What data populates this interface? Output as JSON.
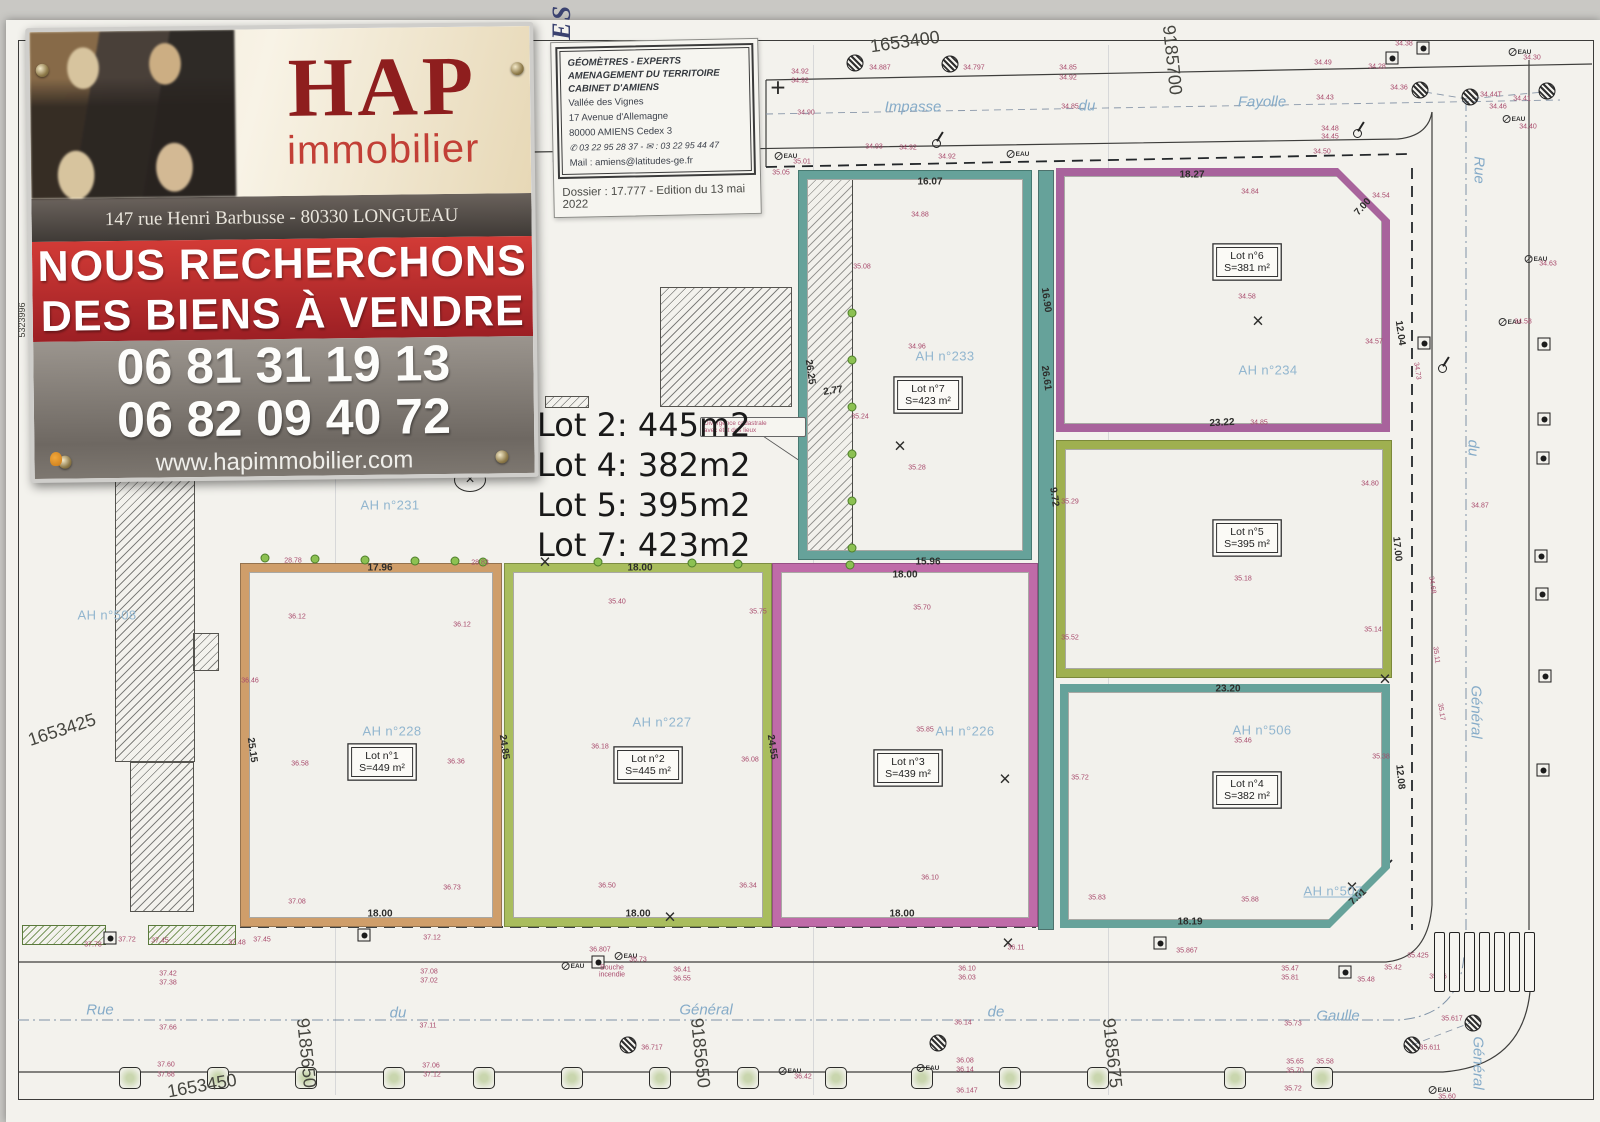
{
  "banner": {
    "brand": "HAP",
    "brand_sub": "immobilier",
    "address": "147 rue Henri Barbusse - 80330 LONGUEAU",
    "line1": "NOUS RECHERCHONS",
    "line2": "DES BIENS À VENDRE",
    "phone1": "06 81 31 19 13",
    "phone2": "06 82 09 40 72",
    "website": "www.hapimmobilier.com",
    "accent_red": "#c0272d",
    "brand_red": "#8e1e1e"
  },
  "cartouche": {
    "side": "LATITUDES",
    "org1": "GÉOMÈTRES - EXPERTS",
    "org2": "AMENAGEMENT DU TERRITOIRE",
    "org3": "CABINET D'AMIENS",
    "addr1": "Vallée des Vignes",
    "addr2": "17 Avenue d'Allemagne",
    "addr3": "80000 AMIENS Cedex 3",
    "tel": "✆ 03 22 95 28 37 - ✉ : 03 22 95 44 47",
    "mail": "Mail : amiens@latitudes-ge.fr",
    "dossier": "Dossier : 17.777 - Edition du 13 mai 2022"
  },
  "notes": {
    "lines": [
      "Lot 2: 445m2",
      "Lot 4: 382m2",
      "Lot 5: 395m2",
      "Lot 7: 423m2"
    ]
  },
  "callout": {
    "line1": "Divergence cadastrale",
    "line2": "avec état des lieux"
  },
  "plan": {
    "eau_label": "EAU",
    "lots": [
      {
        "label": "Lot n°1",
        "area": "S=449 m²"
      },
      {
        "label": "Lot n°2",
        "area": "S=445 m²"
      },
      {
        "label": "Lot n°3",
        "area": "S=439 m²"
      },
      {
        "label": "Lot n°4",
        "area": "S=382 m²"
      },
      {
        "label": "Lot n°5",
        "area": "S=395 m²"
      },
      {
        "label": "Lot n°6",
        "area": "S=381 m²"
      },
      {
        "label": "Lot n°7",
        "area": "S=423 m²"
      }
    ],
    "parcels": [
      {
        "t": "AH n°231",
        "x": 390,
        "y": 505
      },
      {
        "t": "AH n°508",
        "x": 107,
        "y": 615
      },
      {
        "t": "AH n°228",
        "x": 392,
        "y": 731
      },
      {
        "t": "AH n°227",
        "x": 662,
        "y": 722
      },
      {
        "t": "AH n°226",
        "x": 965,
        "y": 731
      },
      {
        "t": "AH n°233",
        "x": 945,
        "y": 356
      },
      {
        "t": "AH n°234",
        "x": 1268,
        "y": 370
      },
      {
        "t": "AH n°506",
        "x": 1262,
        "y": 730
      },
      {
        "t": "AH n°507",
        "x": 1333,
        "y": 891,
        "u": 1
      }
    ],
    "streets": [
      {
        "t": "Impasse",
        "x": 913,
        "y": 107
      },
      {
        "t": "du",
        "x": 1087,
        "y": 106
      },
      {
        "t": "Fayolle",
        "x": 1262,
        "y": 102
      },
      {
        "t": "Rue",
        "x": 1479,
        "y": 170,
        "r": 90
      },
      {
        "t": "du",
        "x": 1473,
        "y": 448,
        "r": 90
      },
      {
        "t": "Général",
        "x": 1476,
        "y": 712,
        "r": 90
      },
      {
        "t": "Général",
        "x": 1478,
        "y": 1063,
        "r": 90
      },
      {
        "t": "Rue",
        "x": 100,
        "y": 1010
      },
      {
        "t": "du",
        "x": 398,
        "y": 1013
      },
      {
        "t": "Général",
        "x": 706,
        "y": 1010
      },
      {
        "t": "de",
        "x": 996,
        "y": 1012
      },
      {
        "t": "Gaulle",
        "x": 1338,
        "y": 1016
      }
    ],
    "coords": [
      {
        "t": "1653400",
        "x": 905,
        "y": 42,
        "r": -8
      },
      {
        "t": "9185700",
        "x": 1172,
        "y": 60,
        "r": 84
      },
      {
        "t": "1653425",
        "x": 62,
        "y": 730,
        "r": -18
      },
      {
        "t": "1653450",
        "x": 202,
        "y": 1086,
        "r": -10
      },
      {
        "t": "9185650",
        "x": 306,
        "y": 1053,
        "r": 84
      },
      {
        "t": "9185650",
        "x": 700,
        "y": 1053,
        "r": 84
      },
      {
        "t": "9185675",
        "x": 1112,
        "y": 1053,
        "r": 84
      },
      {
        "t": "5323996",
        "x": 22,
        "y": 320,
        "r": -90,
        "s": 9
      }
    ],
    "dims": [
      {
        "t": "16.07",
        "x": 930,
        "y": 182
      },
      {
        "t": "18.27",
        "x": 1192,
        "y": 175
      },
      {
        "t": "7.00",
        "x": 1363,
        "y": 207,
        "r": -48
      },
      {
        "t": "16.90",
        "x": 1046,
        "y": 300,
        "r": 82
      },
      {
        "t": "26.61",
        "x": 1046,
        "y": 378,
        "r": 82
      },
      {
        "t": "26.25",
        "x": 810,
        "y": 372,
        "r": 82
      },
      {
        "t": "2.77",
        "x": 833,
        "y": 391,
        "r": -8
      },
      {
        "t": "12.04",
        "x": 1400,
        "y": 333,
        "r": 82
      },
      {
        "t": "23.22",
        "x": 1222,
        "y": 423,
        "r": -3
      },
      {
        "t": "9.72",
        "x": 1054,
        "y": 497,
        "r": 82
      },
      {
        "t": "17.00",
        "x": 1397,
        "y": 549,
        "r": 84
      },
      {
        "t": "15.96",
        "x": 928,
        "y": 562
      },
      {
        "t": "18.00",
        "x": 905,
        "y": 575
      },
      {
        "t": "17.96",
        "x": 380,
        "y": 568
      },
      {
        "t": "18.00",
        "x": 640,
        "y": 568
      },
      {
        "t": "25.15",
        "x": 252,
        "y": 750,
        "r": 82
      },
      {
        "t": "24.85",
        "x": 504,
        "y": 747,
        "r": 82
      },
      {
        "t": "24.55",
        "x": 772,
        "y": 747,
        "r": 82
      },
      {
        "t": "23.20",
        "x": 1228,
        "y": 689
      },
      {
        "t": "12.08",
        "x": 1400,
        "y": 777,
        "r": 84
      },
      {
        "t": "18.00",
        "x": 380,
        "y": 914
      },
      {
        "t": "18.00",
        "x": 638,
        "y": 914
      },
      {
        "t": "18.00",
        "x": 902,
        "y": 914
      },
      {
        "t": "18.19",
        "x": 1190,
        "y": 922
      },
      {
        "t": "7.01",
        "x": 1358,
        "y": 897,
        "r": -42
      }
    ],
    "elev": [
      {
        "t": "34.92",
        "x": 800,
        "y": 72
      },
      {
        "t": "34.92",
        "x": 800,
        "y": 81
      },
      {
        "t": "34.90",
        "x": 806,
        "y": 113
      },
      {
        "t": "35.01",
        "x": 802,
        "y": 162
      },
      {
        "t": "35.05",
        "x": 781,
        "y": 173
      },
      {
        "t": "34.887",
        "x": 880,
        "y": 68
      },
      {
        "t": "34.797",
        "x": 974,
        "y": 68
      },
      {
        "t": "34.93",
        "x": 874,
        "y": 147
      },
      {
        "t": "34.92",
        "x": 908,
        "y": 148
      },
      {
        "t": "34.92",
        "x": 947,
        "y": 157
      },
      {
        "t": "34.85",
        "x": 1068,
        "y": 68
      },
      {
        "t": "34.92",
        "x": 1068,
        "y": 78
      },
      {
        "t": "34.85",
        "x": 1070,
        "y": 107
      },
      {
        "t": "34.49",
        "x": 1323,
        "y": 63
      },
      {
        "t": "34.28",
        "x": 1377,
        "y": 67
      },
      {
        "t": "34.43",
        "x": 1325,
        "y": 98
      },
      {
        "t": "34.48",
        "x": 1330,
        "y": 129
      },
      {
        "t": "34.45",
        "x": 1330,
        "y": 137
      },
      {
        "t": "34.50",
        "x": 1322,
        "y": 152
      },
      {
        "t": "34.38",
        "x": 1404,
        "y": 44
      },
      {
        "t": "34.36",
        "x": 1399,
        "y": 88
      },
      {
        "t": "34.44T",
        "x": 1491,
        "y": 95
      },
      {
        "t": "34.41",
        "x": 1522,
        "y": 99
      },
      {
        "t": "34.46",
        "x": 1498,
        "y": 107
      },
      {
        "t": "34.40",
        "x": 1528,
        "y": 127
      },
      {
        "t": "34.30",
        "x": 1532,
        "y": 58
      },
      {
        "t": "34.84",
        "x": 1250,
        "y": 192
      },
      {
        "t": "34.54",
        "x": 1381,
        "y": 196
      },
      {
        "t": "34.88",
        "x": 920,
        "y": 215
      },
      {
        "t": "34.58",
        "x": 1247,
        "y": 297
      },
      {
        "t": "34.57",
        "x": 1374,
        "y": 342
      },
      {
        "t": "34.96",
        "x": 917,
        "y": 347
      },
      {
        "t": "35.08",
        "x": 862,
        "y": 267
      },
      {
        "t": "35.24",
        "x": 860,
        "y": 417
      },
      {
        "t": "35.28",
        "x": 917,
        "y": 468
      },
      {
        "t": "34.85",
        "x": 1259,
        "y": 423
      },
      {
        "t": "34.80",
        "x": 1370,
        "y": 484
      },
      {
        "t": "35.29",
        "x": 1070,
        "y": 502
      },
      {
        "t": "35.18",
        "x": 1243,
        "y": 579
      },
      {
        "t": "35.52",
        "x": 1070,
        "y": 638
      },
      {
        "t": "35.14",
        "x": 1373,
        "y": 630
      },
      {
        "t": "35.46",
        "x": 1243,
        "y": 741
      },
      {
        "t": "35.38",
        "x": 1381,
        "y": 757
      },
      {
        "t": "35.72",
        "x": 1080,
        "y": 778
      },
      {
        "t": "35.83",
        "x": 1097,
        "y": 898
      },
      {
        "t": "35.88",
        "x": 1250,
        "y": 900
      },
      {
        "t": "36.12",
        "x": 297,
        "y": 617
      },
      {
        "t": "36.12",
        "x": 462,
        "y": 625
      },
      {
        "t": "36.46",
        "x": 250,
        "y": 681
      },
      {
        "t": "36.58",
        "x": 300,
        "y": 764
      },
      {
        "t": "36.36",
        "x": 456,
        "y": 762
      },
      {
        "t": "36.73",
        "x": 452,
        "y": 888
      },
      {
        "t": "37.08",
        "x": 297,
        "y": 902
      },
      {
        "t": "35.40",
        "x": 617,
        "y": 602
      },
      {
        "t": "35.75",
        "x": 758,
        "y": 612
      },
      {
        "t": "36.18",
        "x": 600,
        "y": 747
      },
      {
        "t": "36.08",
        "x": 750,
        "y": 760
      },
      {
        "t": "36.50",
        "x": 607,
        "y": 886
      },
      {
        "t": "36.34",
        "x": 748,
        "y": 886
      },
      {
        "t": "35.70",
        "x": 922,
        "y": 608
      },
      {
        "t": "35.85",
        "x": 925,
        "y": 730
      },
      {
        "t": "36.10",
        "x": 930,
        "y": 878
      },
      {
        "t": "28.78",
        "x": 293,
        "y": 561
      },
      {
        "t": "28.83",
        "x": 480,
        "y": 563
      },
      {
        "t": "34.63",
        "x": 1548,
        "y": 264
      },
      {
        "t": "34.58",
        "x": 1523,
        "y": 322
      },
      {
        "t": "34.87",
        "x": 1480,
        "y": 506
      },
      {
        "t": "34.73",
        "x": 1417,
        "y": 371,
        "r": 82
      },
      {
        "t": "34.68",
        "x": 1432,
        "y": 585,
        "r": 82
      },
      {
        "t": "35.11",
        "x": 1436,
        "y": 655,
        "r": 82
      },
      {
        "t": "35.17",
        "x": 1441,
        "y": 712,
        "r": 82
      },
      {
        "t": "37.78",
        "x": 93,
        "y": 945
      },
      {
        "t": "37.72",
        "x": 127,
        "y": 940
      },
      {
        "t": "37.45",
        "x": 160,
        "y": 941
      },
      {
        "t": "37.48",
        "x": 237,
        "y": 943
      },
      {
        "t": "37.45",
        "x": 262,
        "y": 940
      },
      {
        "t": "37.42",
        "x": 168,
        "y": 974
      },
      {
        "t": "37.38",
        "x": 168,
        "y": 983
      },
      {
        "t": "37.66",
        "x": 168,
        "y": 1028
      },
      {
        "t": "37.60",
        "x": 166,
        "y": 1065
      },
      {
        "t": "37.68",
        "x": 166,
        "y": 1075
      },
      {
        "t": "37.12",
        "x": 432,
        "y": 938
      },
      {
        "t": "37.08",
        "x": 429,
        "y": 972
      },
      {
        "t": "37.02",
        "x": 429,
        "y": 981
      },
      {
        "t": "37.11",
        "x": 428,
        "y": 1026
      },
      {
        "t": "37.06",
        "x": 431,
        "y": 1066
      },
      {
        "t": "37.12",
        "x": 432,
        "y": 1075
      },
      {
        "t": "36.807",
        "x": 600,
        "y": 950
      },
      {
        "t": "36.73",
        "x": 638,
        "y": 960
      },
      {
        "t": "Bouche",
        "x": 612,
        "y": 968
      },
      {
        "t": "incendie",
        "x": 612,
        "y": 975
      },
      {
        "t": "36.41",
        "x": 682,
        "y": 970
      },
      {
        "t": "36.55",
        "x": 682,
        "y": 979
      },
      {
        "t": "36.717",
        "x": 652,
        "y": 1048
      },
      {
        "t": "36.11",
        "x": 1016,
        "y": 948
      },
      {
        "t": "36.10",
        "x": 967,
        "y": 969
      },
      {
        "t": "36.03",
        "x": 967,
        "y": 978
      },
      {
        "t": "36.14",
        "x": 963,
        "y": 1023
      },
      {
        "t": "36.08",
        "x": 965,
        "y": 1061
      },
      {
        "t": "36.14",
        "x": 965,
        "y": 1070
      },
      {
        "t": "36.147",
        "x": 967,
        "y": 1091
      },
      {
        "t": "36.42",
        "x": 803,
        "y": 1077
      },
      {
        "t": "35.867",
        "x": 1187,
        "y": 951
      },
      {
        "t": "35.47",
        "x": 1290,
        "y": 969
      },
      {
        "t": "35.81",
        "x": 1290,
        "y": 978
      },
      {
        "t": "35.48",
        "x": 1366,
        "y": 980
      },
      {
        "t": "35.42",
        "x": 1393,
        "y": 968
      },
      {
        "t": "35.425",
        "x": 1418,
        "y": 956
      },
      {
        "t": "35.56",
        "x": 1438,
        "y": 977
      },
      {
        "t": "35.73",
        "x": 1293,
        "y": 1024
      },
      {
        "t": "35.65",
        "x": 1295,
        "y": 1062
      },
      {
        "t": "35.70",
        "x": 1295,
        "y": 1071
      },
      {
        "t": "35.72",
        "x": 1293,
        "y": 1089
      },
      {
        "t": "35.58",
        "x": 1325,
        "y": 1062
      },
      {
        "t": "35.617",
        "x": 1452,
        "y": 1019
      },
      {
        "t": "35.611",
        "x": 1430,
        "y": 1048
      },
      {
        "t": "35.60",
        "x": 1447,
        "y": 1097
      }
    ],
    "dots": [
      {
        "x": 852,
        "y": 313
      },
      {
        "x": 852,
        "y": 360
      },
      {
        "x": 852,
        "y": 407
      },
      {
        "x": 852,
        "y": 454
      },
      {
        "x": 852,
        "y": 501
      },
      {
        "x": 852,
        "y": 548
      },
      {
        "x": 265,
        "y": 558
      },
      {
        "x": 315,
        "y": 559
      },
      {
        "x": 365,
        "y": 560
      },
      {
        "x": 415,
        "y": 561
      },
      {
        "x": 455,
        "y": 561
      },
      {
        "x": 483,
        "y": 562
      },
      {
        "x": 598,
        "y": 562
      },
      {
        "x": 692,
        "y": 563
      },
      {
        "x": 738,
        "y": 564
      },
      {
        "x": 850,
        "y": 565
      }
    ],
    "trees": [
      {
        "x": 130,
        "y": 1078
      },
      {
        "x": 218,
        "y": 1078
      },
      {
        "x": 306,
        "y": 1078
      },
      {
        "x": 394,
        "y": 1078
      },
      {
        "x": 484,
        "y": 1078
      },
      {
        "x": 572,
        "y": 1078
      },
      {
        "x": 660,
        "y": 1078
      },
      {
        "x": 748,
        "y": 1078
      },
      {
        "x": 836,
        "y": 1078
      },
      {
        "x": 922,
        "y": 1078
      },
      {
        "x": 1010,
        "y": 1078
      },
      {
        "x": 1098,
        "y": 1078
      },
      {
        "x": 1235,
        "y": 1078
      },
      {
        "x": 1322,
        "y": 1078
      }
    ],
    "boxes": [
      {
        "x": 1392,
        "y": 58
      },
      {
        "x": 1423,
        "y": 48
      },
      {
        "x": 1160,
        "y": 943
      },
      {
        "x": 1345,
        "y": 972
      },
      {
        "x": 364,
        "y": 935
      },
      {
        "x": 110,
        "y": 938
      },
      {
        "x": 1424,
        "y": 343
      },
      {
        "x": 1544,
        "y": 344
      },
      {
        "x": 1544,
        "y": 419
      },
      {
        "x": 1543,
        "y": 458
      },
      {
        "x": 1541,
        "y": 556
      },
      {
        "x": 1542,
        "y": 594
      },
      {
        "x": 1545,
        "y": 676
      },
      {
        "x": 1543,
        "y": 770
      },
      {
        "x": 598,
        "y": 962
      }
    ],
    "benchmarks": [
      {
        "x": 855,
        "y": 63
      },
      {
        "x": 950,
        "y": 64
      },
      {
        "x": 1420,
        "y": 90
      },
      {
        "x": 1470,
        "y": 97
      },
      {
        "x": 1547,
        "y": 91
      },
      {
        "x": 628,
        "y": 1045
      },
      {
        "x": 1412,
        "y": 1045
      },
      {
        "x": 1473,
        "y": 1023
      },
      {
        "x": 938,
        "y": 1043
      }
    ],
    "crosses": [
      {
        "t": "×",
        "x": 900,
        "y": 447
      },
      {
        "t": "×",
        "x": 1258,
        "y": 322
      },
      {
        "t": "×",
        "x": 545,
        "y": 563
      },
      {
        "t": "×",
        "x": 670,
        "y": 918
      },
      {
        "t": "×",
        "x": 1005,
        "y": 780
      },
      {
        "t": "×",
        "x": 1385,
        "y": 680
      },
      {
        "t": "×",
        "x": 1008,
        "y": 944
      },
      {
        "t": "×",
        "x": 1352,
        "y": 888
      }
    ],
    "lamps": [
      {
        "x": 937,
        "y": 140
      },
      {
        "x": 1358,
        "y": 130
      },
      {
        "x": 1443,
        "y": 365
      }
    ],
    "eau": [
      {
        "x": 786,
        "y": 156
      },
      {
        "x": 1018,
        "y": 154
      },
      {
        "x": 1520,
        "y": 52
      },
      {
        "x": 1514,
        "y": 119
      },
      {
        "x": 1536,
        "y": 259
      },
      {
        "x": 1510,
        "y": 322
      },
      {
        "x": 573,
        "y": 966
      },
      {
        "x": 626,
        "y": 956
      },
      {
        "x": 790,
        "y": 1071
      },
      {
        "x": 928,
        "y": 1068
      },
      {
        "x": 1440,
        "y": 1090
      }
    ]
  }
}
